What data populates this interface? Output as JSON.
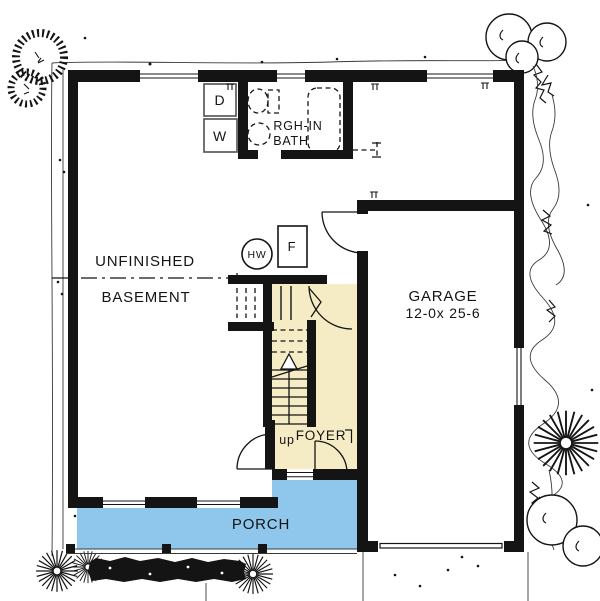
{
  "plan": {
    "rooms": {
      "basement_line1": "UNFINISHED",
      "basement_line2": "BASEMENT",
      "garage_name": "GARAGE",
      "garage_size": "12-0x 25-6",
      "porch": "PORCH",
      "foyer": "FOYER",
      "bath_line1": "RGH-IN",
      "bath_line2": "BATH"
    },
    "stairs": {
      "direction": "up"
    },
    "equipment": {
      "hot_water_heater": "HW",
      "furnace": "F",
      "dryer": "D",
      "washer": "W"
    },
    "colors": {
      "foyer_fill": "#F5ECC6",
      "porch_fill": "#8FC6EC",
      "wall": "#141414",
      "paper": "#FFFFFF"
    }
  }
}
